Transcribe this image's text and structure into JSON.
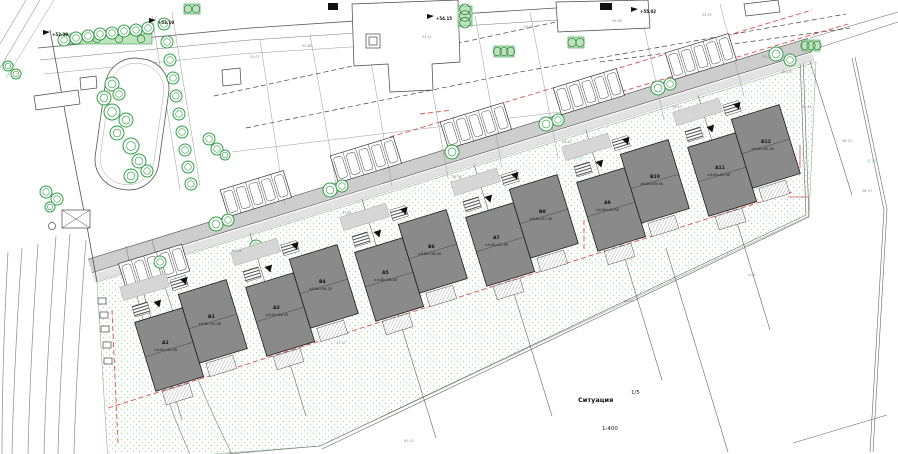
{
  "drawing": {
    "title": "Ситуация",
    "sheet_number": "1/5",
    "scale": "1:400"
  },
  "buildings": [
    {
      "id": "A1",
      "elevation": "±0.00=52.30"
    },
    {
      "id": "B2",
      "elevation": "±0.00=52.30"
    },
    {
      "id": "A3",
      "elevation": "±0.00=54.20"
    },
    {
      "id": "B4",
      "elevation": "±0.00=54.20"
    },
    {
      "id": "A5",
      "elevation": "±0.00=56.00"
    },
    {
      "id": "B6",
      "elevation": "±0.00=56.00"
    },
    {
      "id": "A7",
      "elevation": "±0.00=57.50"
    },
    {
      "id": "B8",
      "elevation": "±0.00=57.50"
    },
    {
      "id": "A9",
      "elevation": "±0.00=59.50"
    },
    {
      "id": "B10",
      "elevation": "±0.00=59.50"
    },
    {
      "id": "A11",
      "elevation": "±0.00=61.00"
    },
    {
      "id": "B12",
      "elevation": "±0.00=61.00"
    }
  ],
  "street_elevations": [
    "+52.30",
    "+53.19",
    "+54.15",
    "+55.02"
  ],
  "level_labels": [
    "-0.75",
    "-0.75"
  ],
  "survey_points": [
    "52.07",
    "52.84",
    "53.11",
    "53.62",
    "54.08",
    "54.55",
    "55.02",
    "55.48",
    "56.13",
    "56.70",
    "57.24",
    "57.81",
    "58.36",
    "58.92",
    "59.47",
    "60.03",
    "17.27",
    "4.00",
    "61.15",
    "56.40"
  ],
  "colors": {
    "building": "#8a8a8a",
    "road": "#cdcdcd",
    "green": "#2f9e44",
    "landscape_dot": "#aed9ae",
    "regulation_red": "#d9534f",
    "level_blue": "#86c5dd"
  }
}
